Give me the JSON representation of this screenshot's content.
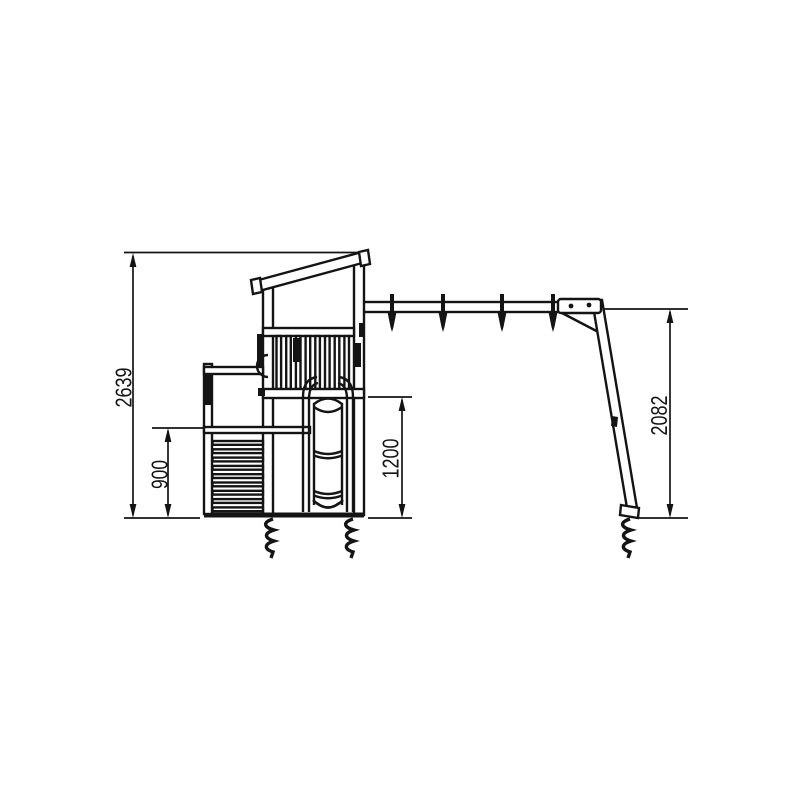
{
  "diagram": {
    "background_color": "#ffffff",
    "line_color": "#141414",
    "dimensions": {
      "overall_height": "2639",
      "lower_platform_height": "900",
      "upper_platform_height": "1200",
      "swing_beam_height": "2082"
    }
  }
}
